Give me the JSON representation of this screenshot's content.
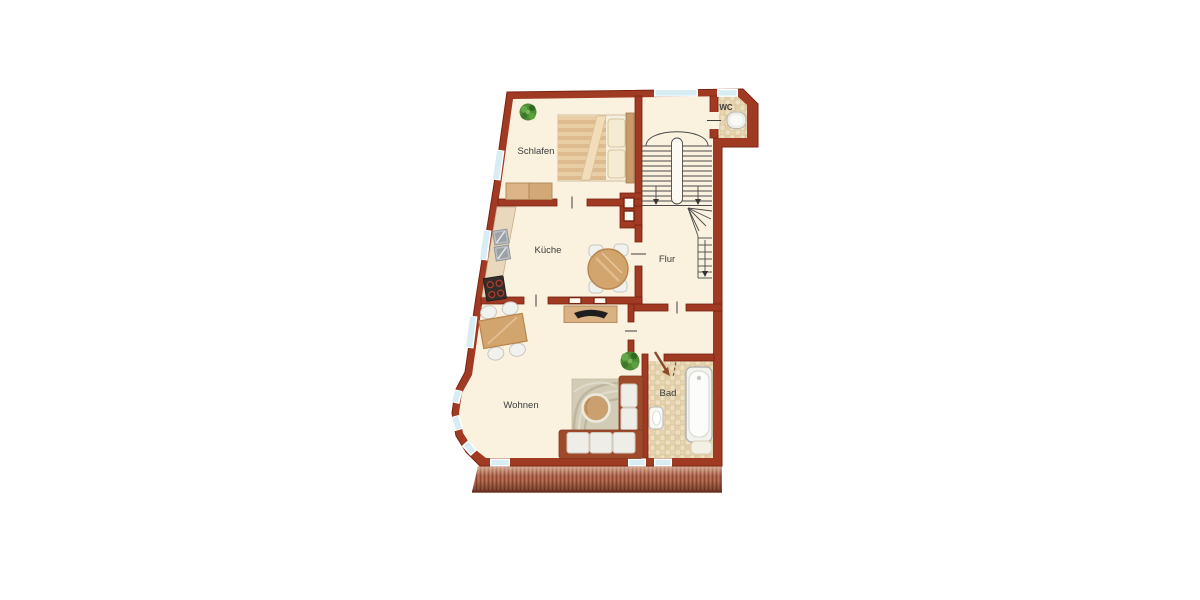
{
  "floor_plan": {
    "background_color": "#ffffff",
    "rooms": [
      {
        "id": "schlafen",
        "label": "Schlafen"
      },
      {
        "id": "kueche",
        "label": "Küche"
      },
      {
        "id": "flur",
        "label": "Flur"
      },
      {
        "id": "wc",
        "label": "WC"
      },
      {
        "id": "wohnen",
        "label": "Wohnen"
      },
      {
        "id": "bad",
        "label": "Bad"
      }
    ],
    "features": [
      "u-staircase",
      "winder-staircase",
      "terrace-deck",
      "bay-windows",
      "chimney-shaft",
      "door-swing-arrow",
      "windows"
    ],
    "furniture": [
      "double-bed",
      "bedroom-dresser",
      "potted-plant",
      "kitchen-counter",
      "double-sink",
      "stove",
      "round-dining-table",
      "dining-chairs",
      "rectangular-dining-table",
      "tv-sideboard",
      "corner-sofa",
      "coffee-table",
      "rug",
      "bathtub",
      "washbasin",
      "bath-mat",
      "toilet"
    ],
    "colors": {
      "wall": "#A03A22",
      "wall_outline": "#7A2412",
      "floor": "#FAF2DF",
      "window": "#D7ECF3",
      "tile_light": "#EDE0C2",
      "tile_dark": "#E2CFA6",
      "terrace": "#AC6049",
      "wood_light": "#D9B183",
      "wood_mid": "#D2A46E",
      "plant_green": "#4F8A35",
      "sofa_frame": "#A04A2C",
      "cushion": "#EFEDE7",
      "stair_line": "#4A4A4A",
      "label_text": "#3C3C3C"
    }
  }
}
